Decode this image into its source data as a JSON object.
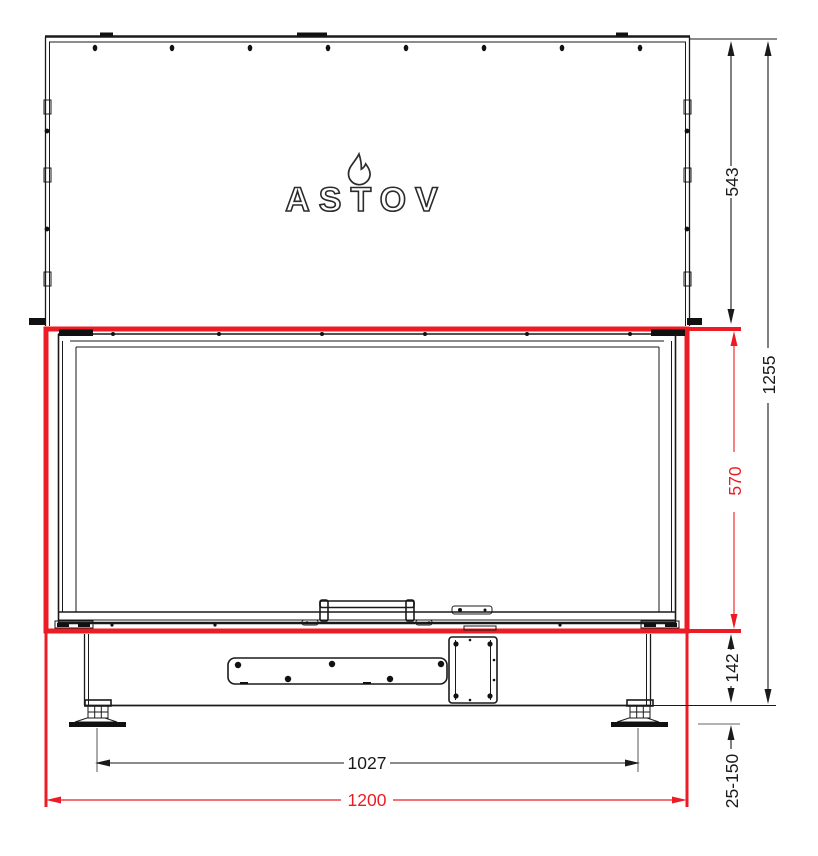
{
  "page": {
    "description": "Front-view dimensioned technical drawing of an ASTOV fireplace insert with red highlighted firebox outline"
  },
  "logo": {
    "brand": "ASTOV",
    "icon": "flame-icon"
  },
  "colors": {
    "highlight_red": "#ed1c24",
    "line_black": "#1a1a1a",
    "extension_gray": "#666666"
  },
  "dimensions": {
    "top_section_height": "543",
    "total_height": "1255",
    "firebox_height": "570",
    "base_height": "142",
    "leg_adjust_range": "25-150",
    "feet_spacing": "1027",
    "total_width": "1200"
  }
}
